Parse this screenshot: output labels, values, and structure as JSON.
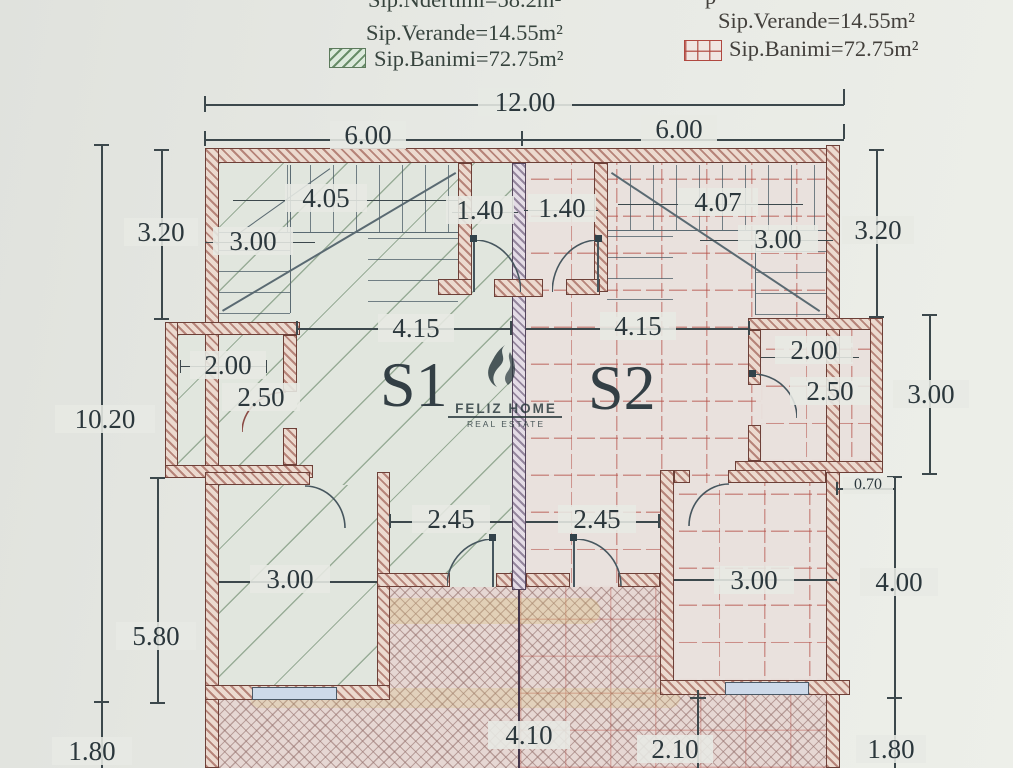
{
  "legend": {
    "left": {
      "line1": "Sip.Ndertimi=58.2m²",
      "line2": "Sip.Verande=14.55m²",
      "line3": "Sip.Banimi=72.75m²"
    },
    "right": {
      "fragment": "p",
      "line2": "Sip.Verande=14.55m²",
      "line3": "Sip.Banimi=72.75m²"
    }
  },
  "units": {
    "left": "S1",
    "right": "S2"
  },
  "watermark": {
    "brand": "FELIZ HOME",
    "tagline": "REAL ESTATE"
  },
  "dims": {
    "top_total": "12.00",
    "top_left": "6.00",
    "top_right": "6.00",
    "left_320": "3.20",
    "left_1020": "10.20",
    "left_580": "5.80",
    "left_180": "1.80",
    "right_320": "3.20",
    "right_300": "3.00",
    "right_400": "4.00",
    "right_180": "1.80",
    "right_070": "0.70",
    "stair_left_w": "4.05",
    "stair_left_h": "3.00",
    "vest_left": "1.40",
    "vest_right": "1.40",
    "stair_right_w": "4.07",
    "stair_right_h": "3.00",
    "hall_left": "4.15",
    "hall_right": "4.15",
    "bath_left_w": "2.00",
    "bath_left_h": "2.50",
    "bath_right_w": "2.00",
    "bath_right_h": "2.50",
    "pass_left": "2.45",
    "pass_right": "2.45",
    "bed_left": "3.00",
    "bed_right": "3.00",
    "veranda_left": "4.10",
    "veranda_right": "2.10"
  },
  "colors": {
    "wall_hatch": "#8a4a40",
    "banimi_green": "#6e8e6e",
    "banimi_red": "#b24a42",
    "paper": "#e6e8e3"
  }
}
